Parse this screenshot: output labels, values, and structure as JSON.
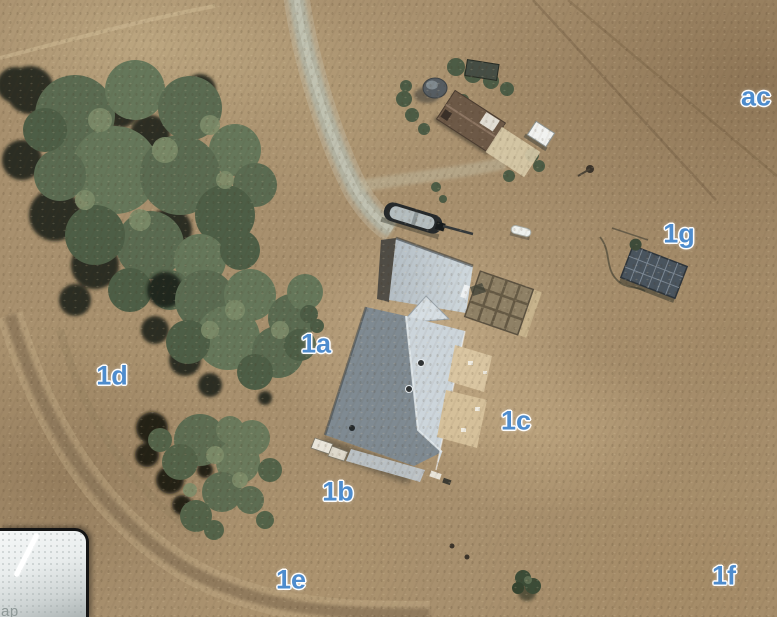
{
  "scene": {
    "kind": "satellite aerial photo of rural homestead",
    "map_labels": [
      {
        "text": "ac",
        "x": 756,
        "y": 97
      },
      {
        "text": "1g",
        "x": 679,
        "y": 234
      },
      {
        "text": "1a",
        "x": 316,
        "y": 344
      },
      {
        "text": "1d",
        "x": 112,
        "y": 376
      },
      {
        "text": "1c",
        "x": 516,
        "y": 421
      },
      {
        "text": "1b",
        "x": 338,
        "y": 492
      },
      {
        "text": "1e",
        "x": 291,
        "y": 580
      },
      {
        "text": "1f",
        "x": 724,
        "y": 576
      }
    ],
    "label_style": {
      "color": "#4e8ccd",
      "outline": "#ffffff"
    }
  },
  "inset_map": {
    "attribution_partial": "ap"
  }
}
